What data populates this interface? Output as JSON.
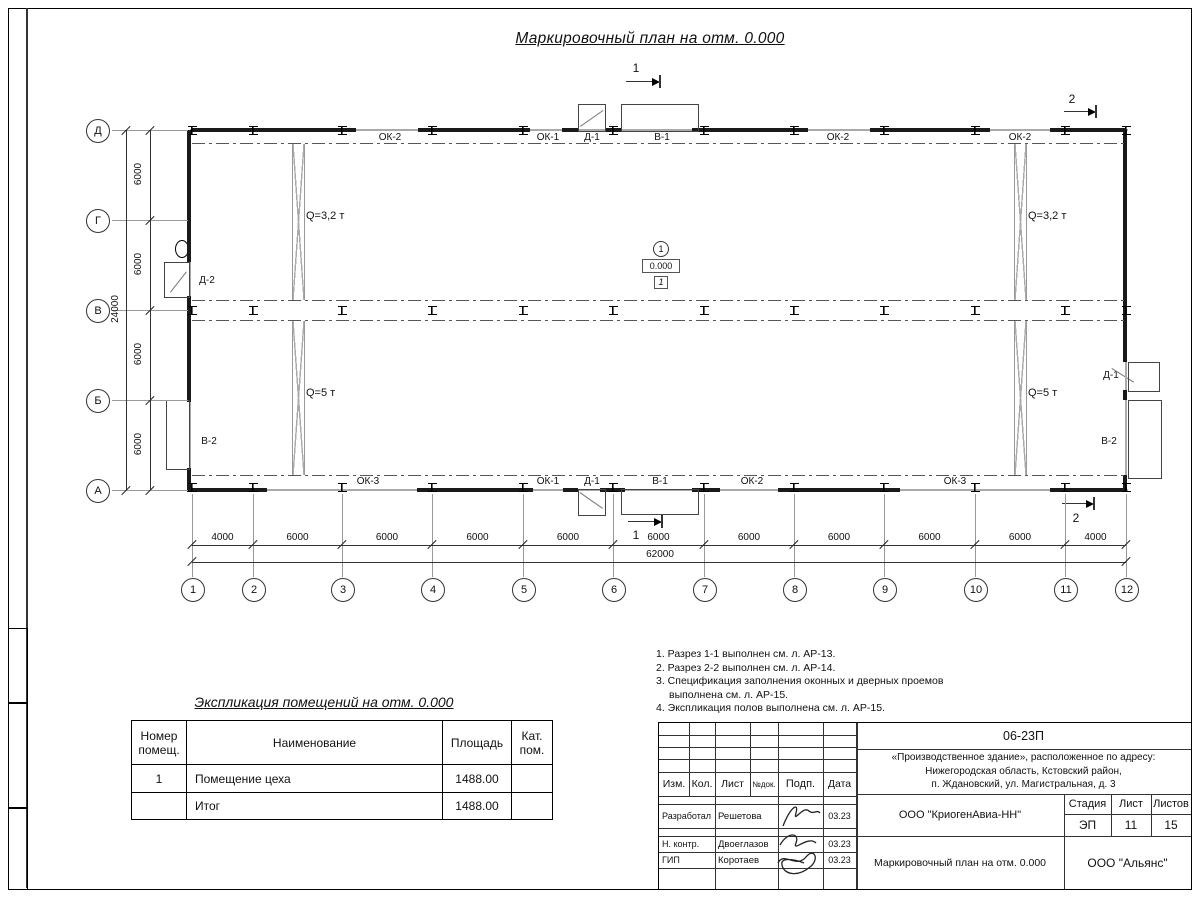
{
  "sheet": {
    "title": "Маркировочный план на отм. 0.000"
  },
  "plan": {
    "grid_cols": [
      "1",
      "2",
      "3",
      "4",
      "5",
      "6",
      "7",
      "8",
      "9",
      "10",
      "11",
      "12"
    ],
    "grid_rows": [
      "Д",
      "Г",
      "В",
      "Б",
      "А"
    ],
    "dims_bottom": [
      "4000",
      "6000",
      "6000",
      "6000",
      "6000",
      "6000",
      "6000",
      "6000",
      "6000",
      "6000",
      "4000"
    ],
    "total_bottom": "62000",
    "dims_left": [
      "6000",
      "6000",
      "6000",
      "6000"
    ],
    "total_left": "24000",
    "openings_top": [
      "ОК-2",
      "ОК-1",
      "Д-1",
      "В-1",
      "ОК-2",
      "ОК-2"
    ],
    "openings_bottom": [
      "ОК-3",
      "ОК-1",
      "Д-1",
      "В-1",
      "ОК-2",
      "ОК-3"
    ],
    "left_wall_labels": [
      "Д-2",
      "В-2"
    ],
    "right_wall_labels": [
      "Д-1",
      "В-2"
    ],
    "cranes": {
      "left_top": "Q=3,2 т",
      "left_bottom": "Q=5 т",
      "right_top": "Q=3,2 т",
      "right_bottom": "Q=5 т"
    },
    "room": {
      "number": "1",
      "elevation": "0.000",
      "floor_type": "1"
    },
    "sections": {
      "s1": "1",
      "s2": "2"
    }
  },
  "notes": [
    "1. Разрез 1-1 выполнен см. л. АР-13.",
    "2. Разрез 2-2 выполнен см. л. АР-14.",
    "3. Спецификация заполнения оконных и дверных проемов выполнена см. л. АР-15.",
    "4. Экспликация полов выполнена см. л. АР-15."
  ],
  "explication": {
    "title": "Экспликация помещений на отм. 0.000",
    "headers": [
      "Номер помещ.",
      "Наименование",
      "Площадь",
      "Кат. пом."
    ],
    "rows": [
      [
        "1",
        "Помещение цеха",
        "1488.00",
        ""
      ],
      [
        "",
        "Итог",
        "1488.00",
        ""
      ]
    ]
  },
  "title_block": {
    "doc_number": "06-23П",
    "object_lines": [
      "«Производственное здание», расположенное по адресу:",
      "Нижегородская область, Кстовский район,",
      "п. Ждановский, ул. Магистральная, д. 3"
    ],
    "header_cols": [
      "Изм.",
      "Кол.",
      "Лист",
      "№док.",
      "Подп.",
      "Дата"
    ],
    "stage_headers": [
      "Стадия",
      "Лист",
      "Листов"
    ],
    "stage_values": [
      "ЭП",
      "11",
      "15"
    ],
    "org1": "ООО \"КриогенАвиа-НН\"",
    "org2": "ООО \"Альянс\"",
    "plan_name": "Маркировочный план на отм. 0.000",
    "roles": [
      {
        "role": "Разработал",
        "name": "Решетова",
        "date": "03.23"
      },
      {
        "role": "Н. контр.",
        "name": "Двоеглазов",
        "date": "03.23"
      },
      {
        "role": "ГИП",
        "name": "Коротаев",
        "date": "03.23"
      }
    ]
  }
}
